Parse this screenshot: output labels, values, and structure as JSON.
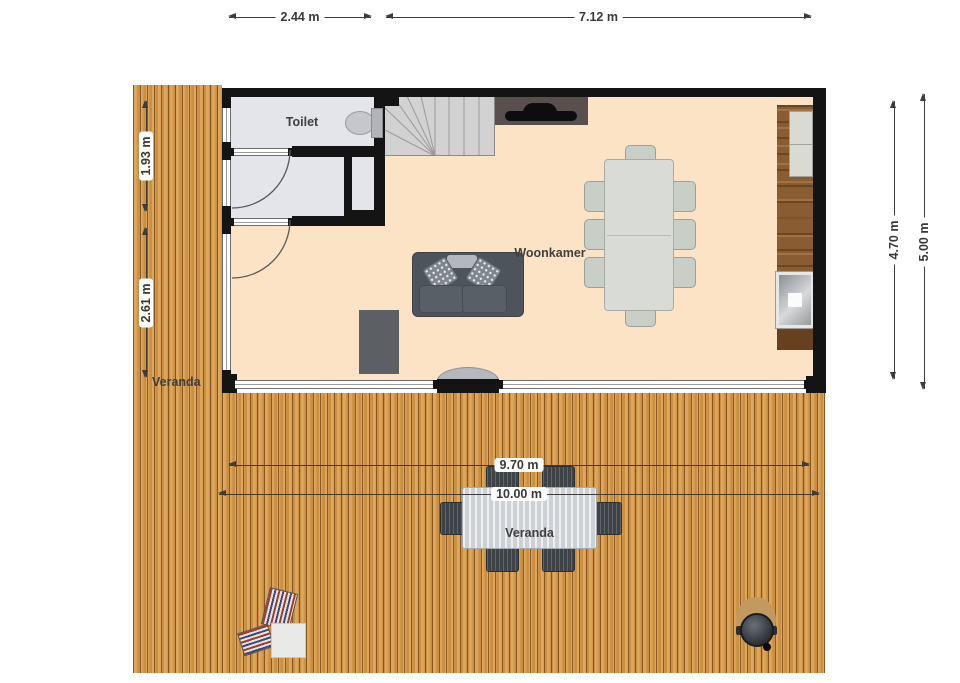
{
  "rooms": {
    "toilet": "Toilet",
    "living": "Woonkamer",
    "veranda_left": "Veranda",
    "veranda_table": "Veranda"
  },
  "dimensions": {
    "top_small": "2.44 m",
    "top_large": "7.12 m",
    "left_upper": "1.93 m",
    "left_lower": "2.61 m",
    "right_inner": "4.70 m",
    "right_outer": "5.00 m",
    "deck_inner": "9.70 m",
    "deck_outer": "10.00 m"
  },
  "colors": {
    "wall": "#141414",
    "living_floor": "#fce3c5",
    "wet_floor": "#e4e5eb",
    "deck_wood": "#d49849",
    "counter_wood": "#8a5c32",
    "dim_text": "#383838"
  }
}
